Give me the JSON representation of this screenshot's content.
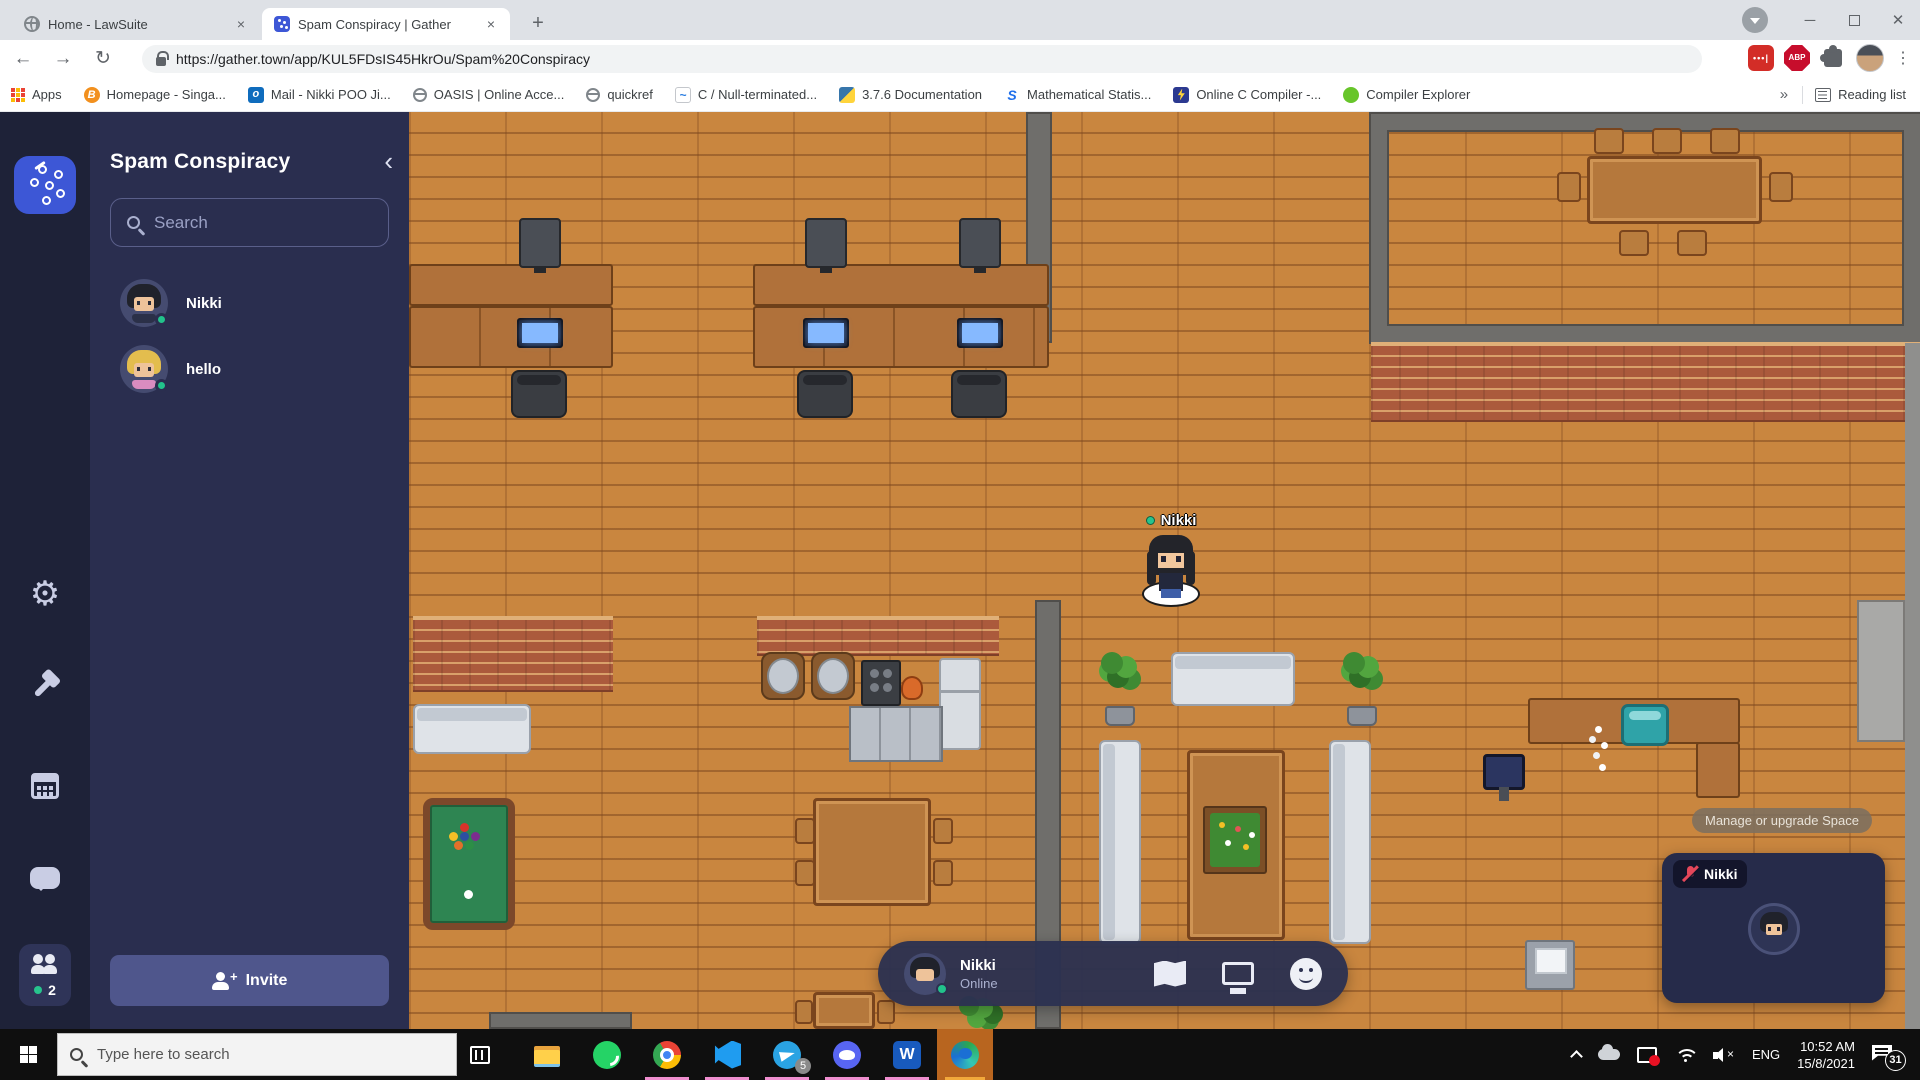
{
  "browser": {
    "tabs": [
      {
        "label": "Home - LawSuite",
        "icon": "globe-favicon"
      },
      {
        "label": "Spam Conspiracy | Gather",
        "icon": "gather-favicon"
      }
    ],
    "url": "https://gather.town/app/KUL5FDsIS45HkrOu/Spam%20Conspiracy",
    "apps_label": "Apps",
    "bookmarks": [
      {
        "label": "Homepage - Singa...",
        "kind": "orange-b"
      },
      {
        "label": "Mail - Nikki POO Ji...",
        "kind": "outlook"
      },
      {
        "label": "OASIS | Online Acce...",
        "kind": "globe"
      },
      {
        "label": "quickref",
        "kind": "globe"
      },
      {
        "label": "C / Null-terminated...",
        "kind": "code"
      },
      {
        "label": "3.7.6 Documentation",
        "kind": "python"
      },
      {
        "label": "Mathematical Statis...",
        "kind": "sblue"
      },
      {
        "label": "Online C Compiler -...",
        "kind": "bolt"
      },
      {
        "label": "Compiler Explorer",
        "kind": "ce"
      }
    ],
    "overflow": "»",
    "reading_list": "Reading list"
  },
  "gather": {
    "space_name": "Spam Conspiracy",
    "search_placeholder": "Search",
    "members": [
      {
        "name": "Nikki",
        "avatar": "dark"
      },
      {
        "name": "hello",
        "avatar": "blonde"
      }
    ],
    "online_count": "2",
    "invite_label": "Invite"
  },
  "game": {
    "player_name": "Nikki",
    "tooltip": "Manage or upgrade Space",
    "objects": [
      {
        "name": "wall-top-divider",
        "kind": "wall",
        "x": 617,
        "y": 0,
        "w": 26,
        "h": 231
      },
      {
        "name": "wall-mid-divider",
        "kind": "wall",
        "x": 626,
        "y": 488,
        "w": 26,
        "h": 429
      },
      {
        "name": "conference-room-walls",
        "kind": "room",
        "x": 962,
        "y": 2,
        "w": 549,
        "h": 228
      },
      {
        "name": "brick-wall-right",
        "kind": "brick",
        "x": 962,
        "y": 230,
        "w": 549,
        "h": 80
      },
      {
        "name": "brick-wall-left",
        "kind": "brick",
        "x": 4,
        "y": 504,
        "w": 200,
        "h": 76
      },
      {
        "name": "brick-wall-mid",
        "kind": "brick",
        "x": 348,
        "y": 504,
        "w": 242,
        "h": 40
      },
      {
        "name": "wall-right-column",
        "kind": "col",
        "x": 1496,
        "y": 231,
        "w": 15,
        "h": 686
      },
      {
        "name": "wall-reception-right",
        "kind": "wall-light",
        "x": 1448,
        "y": 488,
        "w": 48,
        "h": 142
      },
      {
        "name": "wall-bottom-left",
        "kind": "wall",
        "x": 80,
        "y": 900,
        "w": 143,
        "h": 17
      },
      {
        "name": "desk-a-top",
        "kind": "desk",
        "x": 0,
        "y": 152,
        "w": 204,
        "h": 42
      },
      {
        "name": "monitor-a",
        "kind": "monitor",
        "x": 110,
        "y": 106,
        "w": 42,
        "h": 50
      },
      {
        "name": "desk-a-bottom",
        "kind": "desk2",
        "x": 0,
        "y": 194,
        "w": 204,
        "h": 62
      },
      {
        "name": "screen-a",
        "kind": "screen",
        "x": 108,
        "y": 206,
        "w": 46,
        "h": 30
      },
      {
        "name": "chair-a",
        "kind": "chair",
        "x": 102,
        "y": 258,
        "w": 56,
        "h": 48
      },
      {
        "name": "desk-b-top",
        "kind": "desk",
        "x": 344,
        "y": 152,
        "w": 296,
        "h": 42
      },
      {
        "name": "monitor-b1",
        "kind": "monitor",
        "x": 396,
        "y": 106,
        "w": 42,
        "h": 50
      },
      {
        "name": "monitor-b2",
        "kind": "monitor",
        "x": 550,
        "y": 106,
        "w": 42,
        "h": 50
      },
      {
        "name": "desk-b-bottom",
        "kind": "desk2",
        "x": 344,
        "y": 194,
        "w": 296,
        "h": 62
      },
      {
        "name": "screen-b1",
        "kind": "screen",
        "x": 394,
        "y": 206,
        "w": 46,
        "h": 30
      },
      {
        "name": "screen-b2",
        "kind": "screen",
        "x": 548,
        "y": 206,
        "w": 46,
        "h": 30
      },
      {
        "name": "chair-b1",
        "kind": "chair",
        "x": 388,
        "y": 258,
        "w": 56,
        "h": 48
      },
      {
        "name": "chair-b2",
        "kind": "chair",
        "x": 542,
        "y": 258,
        "w": 56,
        "h": 48
      },
      {
        "name": "conference-table",
        "kind": "table",
        "x": 1178,
        "y": 44,
        "w": 175,
        "h": 68
      },
      {
        "name": "conf-chair-1",
        "kind": "chair-wood",
        "x": 1185,
        "y": 16,
        "w": 30,
        "h": 26
      },
      {
        "name": "conf-chair-2",
        "kind": "chair-wood",
        "x": 1243,
        "y": 16,
        "w": 30,
        "h": 26
      },
      {
        "name": "conf-chair-3",
        "kind": "chair-wood",
        "x": 1301,
        "y": 16,
        "w": 30,
        "h": 26
      },
      {
        "name": "conf-chair-4",
        "kind": "chair-wood",
        "x": 1360,
        "y": 60,
        "w": 24,
        "h": 30
      },
      {
        "name": "conf-chair-5",
        "kind": "chair-wood",
        "x": 1148,
        "y": 60,
        "w": 24,
        "h": 30
      },
      {
        "name": "conf-chair-6",
        "kind": "chair-wood",
        "x": 1210,
        "y": 118,
        "w": 30,
        "h": 26
      },
      {
        "name": "conf-chair-7",
        "kind": "chair-wood",
        "x": 1268,
        "y": 118,
        "w": 30,
        "h": 26
      },
      {
        "name": "kitchen-round-table-1",
        "kind": "round-table",
        "x": 352,
        "y": 540,
        "w": 44,
        "h": 48
      },
      {
        "name": "kitchen-round-table-2",
        "kind": "round-table",
        "x": 402,
        "y": 540,
        "w": 44,
        "h": 48
      },
      {
        "name": "stove",
        "kind": "stove",
        "x": 452,
        "y": 548,
        "w": 40,
        "h": 46
      },
      {
        "name": "cooking-pot",
        "kind": "pot",
        "x": 492,
        "y": 564,
        "w": 22,
        "h": 24
      },
      {
        "name": "fridge",
        "kind": "fridge",
        "x": 530,
        "y": 546,
        "w": 42,
        "h": 92
      },
      {
        "name": "kitchen-counter",
        "kind": "counter",
        "x": 440,
        "y": 594,
        "w": 94,
        "h": 56
      },
      {
        "name": "couch-left",
        "kind": "couch",
        "x": 4,
        "y": 592,
        "w": 118,
        "h": 50
      },
      {
        "name": "pool-table",
        "kind": "pool",
        "x": 14,
        "y": 686,
        "w": 92,
        "h": 132
      },
      {
        "name": "dining-table",
        "kind": "table",
        "x": 404,
        "y": 686,
        "w": 118,
        "h": 108
      },
      {
        "name": "dining-chair-1",
        "kind": "chair-wood",
        "x": 386,
        "y": 706,
        "w": 20,
        "h": 26
      },
      {
        "name": "dining-chair-2",
        "kind": "chair-wood",
        "x": 386,
        "y": 748,
        "w": 20,
        "h": 26
      },
      {
        "name": "dining-chair-3",
        "kind": "chair-wood",
        "x": 524,
        "y": 706,
        "w": 20,
        "h": 26
      },
      {
        "name": "dining-chair-4",
        "kind": "chair-wood",
        "x": 524,
        "y": 748,
        "w": 20,
        "h": 26
      },
      {
        "name": "small-table",
        "kind": "table",
        "x": 404,
        "y": 880,
        "w": 62,
        "h": 37
      },
      {
        "name": "small-chair-1",
        "kind": "chair-wood",
        "x": 386,
        "y": 888,
        "w": 18,
        "h": 24
      },
      {
        "name": "small-chair-2",
        "kind": "chair-wood",
        "x": 468,
        "y": 888,
        "w": 18,
        "h": 24
      },
      {
        "name": "bush",
        "kind": "bush",
        "x": 546,
        "y": 880,
        "w": 48,
        "h": 37
      },
      {
        "name": "plant-1",
        "kind": "plant",
        "x": 686,
        "y": 540,
        "w": 48,
        "h": 74
      },
      {
        "name": "plant-2",
        "kind": "plant",
        "x": 928,
        "y": 540,
        "w": 48,
        "h": 74
      },
      {
        "name": "couch-top",
        "kind": "couch",
        "x": 762,
        "y": 540,
        "w": 124,
        "h": 54
      },
      {
        "name": "couch-side-1",
        "kind": "couch-v",
        "x": 690,
        "y": 628,
        "w": 42,
        "h": 204
      },
      {
        "name": "couch-side-2",
        "kind": "couch-v",
        "x": 920,
        "y": 628,
        "w": 42,
        "h": 204
      },
      {
        "name": "lounge-table",
        "kind": "table",
        "x": 778,
        "y": 638,
        "w": 98,
        "h": 190
      },
      {
        "name": "flower-planter",
        "kind": "planter",
        "x": 794,
        "y": 694,
        "w": 64,
        "h": 68
      },
      {
        "name": "reception-desk",
        "kind": "desk",
        "x": 1119,
        "y": 586,
        "w": 212,
        "h": 46
      },
      {
        "name": "reception-desk-side",
        "kind": "desk",
        "x": 1287,
        "y": 630,
        "w": 44,
        "h": 56
      },
      {
        "name": "aquarium",
        "kind": "tank",
        "x": 1212,
        "y": 592,
        "w": 48,
        "h": 42
      },
      {
        "name": "reception-flowers",
        "kind": "flowers",
        "x": 1176,
        "y": 606,
        "w": 26,
        "h": 62
      },
      {
        "name": "reception-monitor",
        "kind": "pcmon",
        "x": 1074,
        "y": 642,
        "w": 42,
        "h": 36
      },
      {
        "name": "laptop-desk",
        "kind": "laptop",
        "x": 1116,
        "y": 828,
        "w": 50,
        "h": 50
      }
    ]
  },
  "control_bar": {
    "name": "Nikki",
    "status": "Online"
  },
  "video_panel": {
    "name": "Nikki"
  },
  "taskbar": {
    "search_placeholder": "Type here to search",
    "apps": [
      {
        "name": "file-explorer",
        "running": false,
        "active": false
      },
      {
        "name": "whatsapp",
        "running": false,
        "active": false
      },
      {
        "name": "chrome",
        "running": true,
        "active": false
      },
      {
        "name": "vscode",
        "running": true,
        "active": false
      },
      {
        "name": "telegram",
        "running": true,
        "active": false,
        "badge": "5"
      },
      {
        "name": "discord",
        "running": true,
        "active": false
      },
      {
        "name": "word",
        "running": true,
        "active": false
      },
      {
        "name": "edge",
        "running": true,
        "active": true
      }
    ],
    "tray": {
      "language": "ENG",
      "time": "10:52 AM",
      "date": "15/8/2021",
      "notification_count": "31"
    }
  },
  "colors": {
    "gather_blue": "#3d57d6",
    "online_green": "#27c48d",
    "sidebar_panel": "#2a2e4f",
    "taskbar_underline": "#ef8ecf",
    "active_tile_orange": "#b8651f"
  }
}
